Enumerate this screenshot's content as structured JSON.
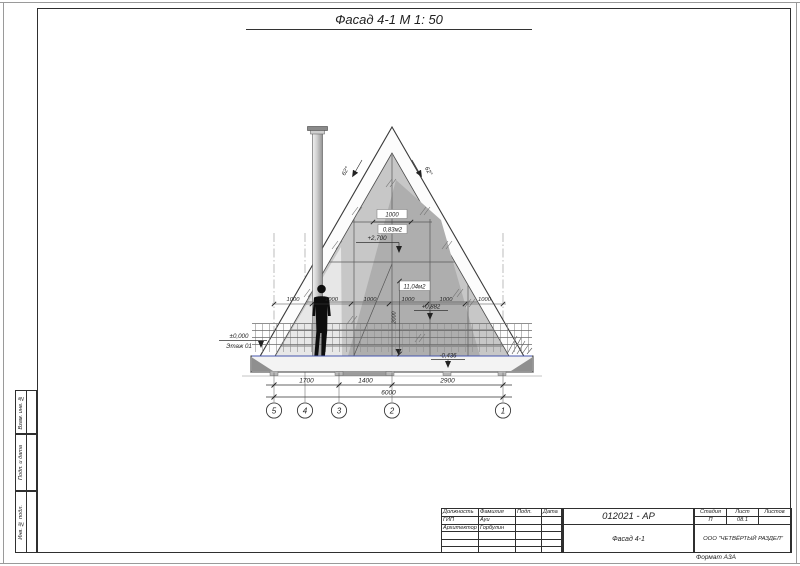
{
  "page": {
    "title": "Фасад 4-1 М 1: 50",
    "format_label": "Формат А3А"
  },
  "side_strip": {
    "cell1": "Взам. инв. №",
    "cell2": "Подп. и дата",
    "cell3": "Инв. № подл."
  },
  "title_block": {
    "col_role": "Должность",
    "col_name": "Фамилия",
    "col_sign": "Подп.",
    "col_date": "Дата",
    "row1_role": "ГИП",
    "row1_name": "Ауи",
    "row2_role": "Архитектор",
    "row2_name": "Горбулин",
    "doc_number": "012021 - АР",
    "drawing_name": "Фасад 4-1",
    "stage_label": "Стадия",
    "sheet_label": "Лист",
    "sheets_label": "Листов",
    "stage_value": "П",
    "sheet_value": "08.1",
    "sheets_value": "",
    "company": "ООО \"ЧЕТВЁРТЫЙ РАЗДЕЛ\""
  },
  "drawing": {
    "angle_left": "62°",
    "angle_right": "62°",
    "dim_window": "1000",
    "area_small": "0,83м2",
    "area_large": "11,04м2",
    "level_mid": "+2,700",
    "level_rail": "+0,882",
    "level_zero": "±0,000",
    "level_zero_floor": "Этаж 01",
    "level_ground": "-0,436",
    "dim_vertical": "2000",
    "panel_dims": [
      "1000",
      "1000",
      "1000",
      "1000",
      "1000",
      "1000"
    ],
    "dims_bottom": [
      "1700",
      "1400",
      "2900"
    ],
    "dim_total": "6000",
    "grid_bubbles": [
      "5",
      "4",
      "3",
      "2",
      "1"
    ]
  }
}
